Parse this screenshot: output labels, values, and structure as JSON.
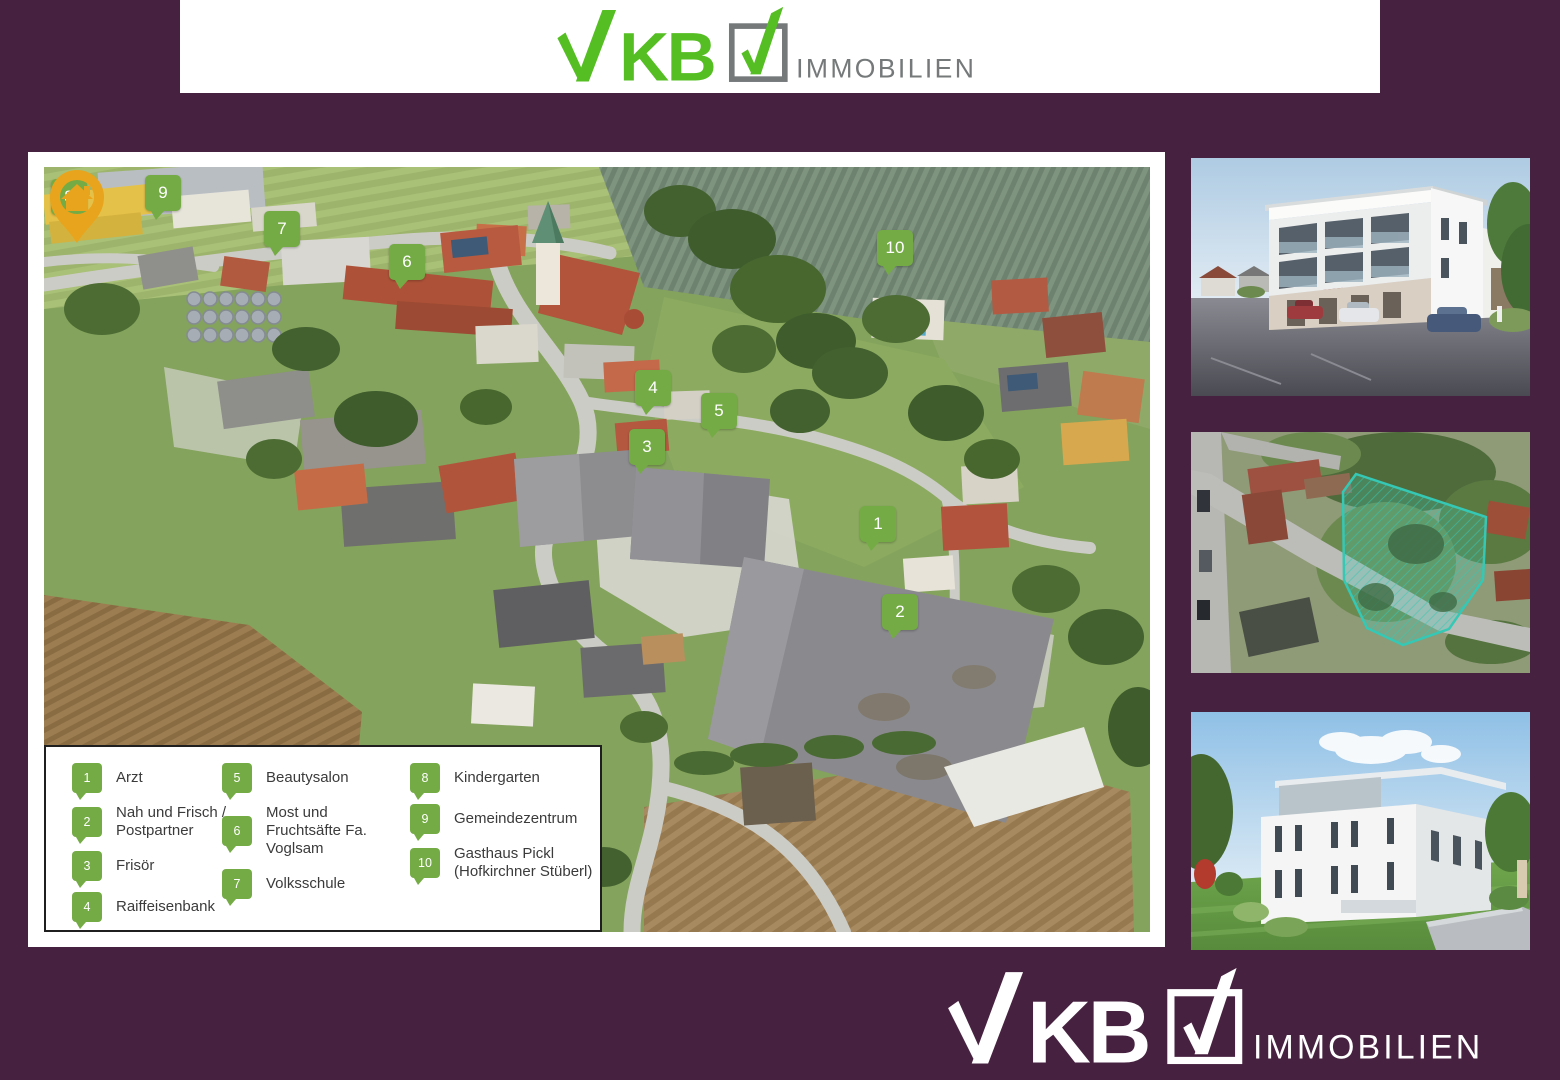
{
  "brand": {
    "name": "VKB",
    "wordmark_kb": "KB",
    "suffix": "IMMOBILIEN"
  },
  "colors": {
    "background_purple": "#472140",
    "logo_green": "#55BE23",
    "logo_gray": "#75797A",
    "marker_green": "#74AB45",
    "pin_orange": "#E8A41C",
    "parcel_teal": "#35C8B4"
  },
  "map": {
    "markers": [
      {
        "num": "1",
        "x": 834,
        "y": 357
      },
      {
        "num": "2",
        "x": 856,
        "y": 445
      },
      {
        "num": "3",
        "x": 603,
        "y": 280
      },
      {
        "num": "4",
        "x": 609,
        "y": 221
      },
      {
        "num": "5",
        "x": 675,
        "y": 244
      },
      {
        "num": "6",
        "x": 363,
        "y": 95
      },
      {
        "num": "7",
        "x": 238,
        "y": 62
      },
      {
        "num": "8",
        "x": 25,
        "y": 30
      },
      {
        "num": "9",
        "x": 119,
        "y": 26
      },
      {
        "num": "10",
        "x": 851,
        "y": 81
      }
    ],
    "pin": {
      "icon": "house-location-pin",
      "x": 831,
      "y": 256
    }
  },
  "legend": {
    "columns": [
      [
        {
          "num": "1",
          "label": "Arzt"
        },
        {
          "num": "2",
          "label": "Nah und Frisch / Postpartner"
        },
        {
          "num": "3",
          "label": "Frisör"
        },
        {
          "num": "4",
          "label": "Raiffeisenbank"
        }
      ],
      [
        {
          "num": "5",
          "label": "Beautysalon"
        },
        {
          "num": "6",
          "label": "Most und Fruchtsäfte Fa. Voglsam"
        },
        {
          "num": "7",
          "label": "Volksschule"
        }
      ],
      [
        {
          "num": "8",
          "label": "Kindergarten"
        },
        {
          "num": "9",
          "label": "Gemeindezentrum"
        },
        {
          "num": "10",
          "label": "Gasthaus Pickl (Hofkirchner Stüberl)"
        }
      ]
    ]
  }
}
